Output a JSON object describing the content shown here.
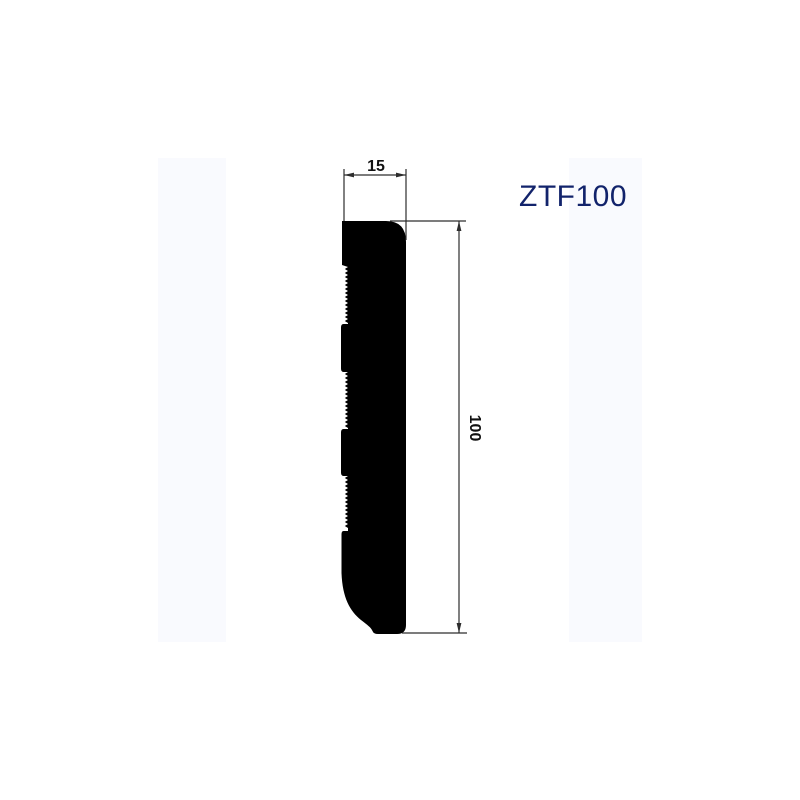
{
  "product": {
    "code": "ZTF100"
  },
  "drawing": {
    "width_dimension": "15",
    "height_dimension": "100"
  },
  "colors": {
    "profile": "#000000",
    "dimension_lines": "#2d2d2d",
    "code_label": "#12236b",
    "background_band": "#f9fafe"
  }
}
